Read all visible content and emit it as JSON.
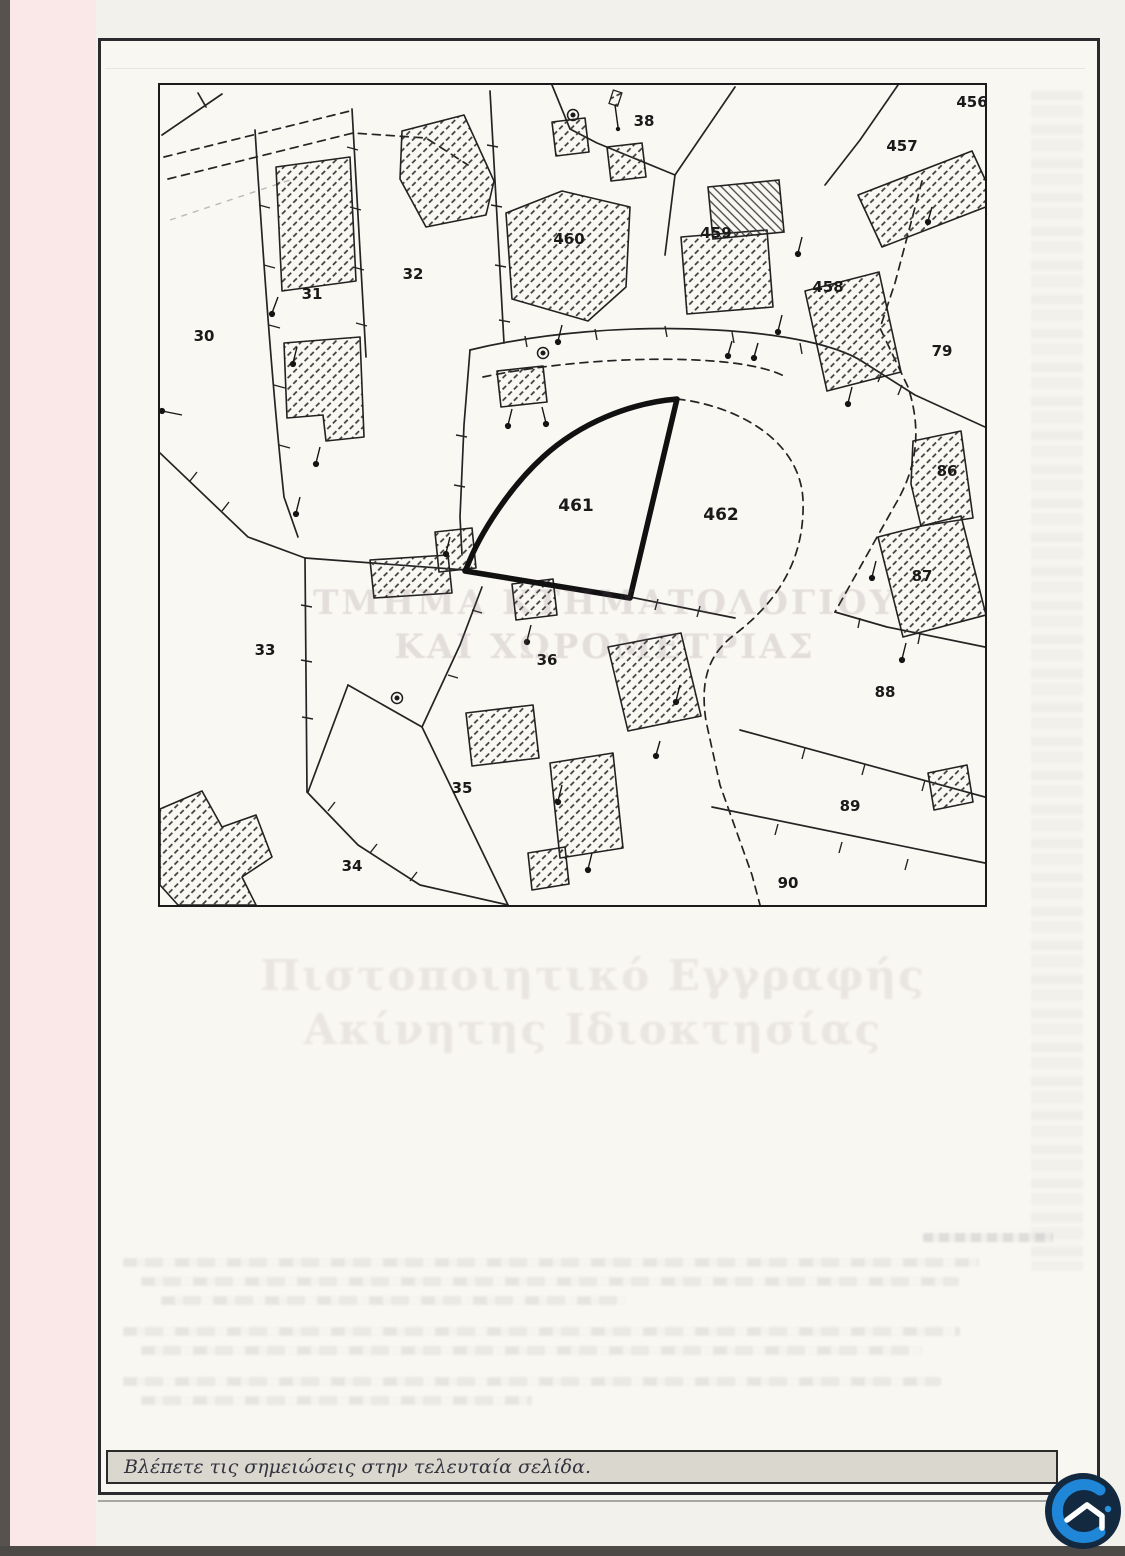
{
  "document": {
    "watermark": {
      "line1": "ΤΜΗΜΑ ΚΤΗΜΑΤΟΛΟΓΙΟΥ",
      "line2": "ΚΑΙ ΧΩΡΟΜΕΤΡΙΑΣ"
    },
    "stamp": {
      "line1": "Πιστοποιητικό Εγγραφής",
      "line2": "Ακίνητης Ιδιοκτησίας"
    },
    "footer_note": "Βλέπετε τις σημειώσεις στην τελευταία σελίδα."
  },
  "map": {
    "highlighted_parcel": "461",
    "parcels": [
      {
        "id": "30",
        "x": 44,
        "y": 256,
        "size": 15
      },
      {
        "id": "31",
        "x": 152,
        "y": 214,
        "size": 15
      },
      {
        "id": "32",
        "x": 253,
        "y": 194,
        "size": 15
      },
      {
        "id": "33",
        "x": 105,
        "y": 570,
        "size": 15
      },
      {
        "id": "34",
        "x": 192,
        "y": 786,
        "size": 15
      },
      {
        "id": "35",
        "x": 302,
        "y": 708,
        "size": 15
      },
      {
        "id": "36",
        "x": 387,
        "y": 580,
        "size": 15
      },
      {
        "id": "38",
        "x": 484,
        "y": 41,
        "size": 15
      },
      {
        "id": "456",
        "x": 812,
        "y": 22,
        "size": 15
      },
      {
        "id": "457",
        "x": 742,
        "y": 66,
        "size": 15
      },
      {
        "id": "458",
        "x": 668,
        "y": 207,
        "size": 15
      },
      {
        "id": "459",
        "x": 556,
        "y": 153,
        "size": 15
      },
      {
        "id": "460",
        "x": 409,
        "y": 159,
        "size": 15
      },
      {
        "id": "461",
        "x": 416,
        "y": 426,
        "size": 17
      },
      {
        "id": "462",
        "x": 561,
        "y": 435,
        "size": 17
      },
      {
        "id": "79",
        "x": 782,
        "y": 271,
        "size": 15
      },
      {
        "id": "86",
        "x": 787,
        "y": 391,
        "size": 15
      },
      {
        "id": "87",
        "x": 762,
        "y": 496,
        "size": 15
      },
      {
        "id": "88",
        "x": 725,
        "y": 612,
        "size": 15
      },
      {
        "id": "89",
        "x": 690,
        "y": 726,
        "size": 15
      },
      {
        "id": "90",
        "x": 628,
        "y": 803,
        "size": 15
      }
    ]
  },
  "logo": {
    "background": "#13293f",
    "c_color": "#1f86d8",
    "mark_color": "#ffffff",
    "accent_dot": "#2a93e0"
  }
}
